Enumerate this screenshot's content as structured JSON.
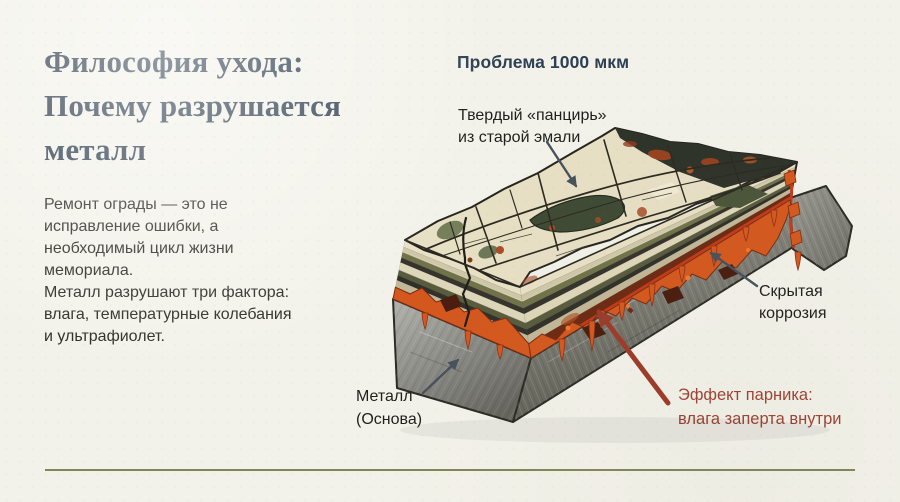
{
  "theme": {
    "background": "#f3f2ea",
    "title_color": "#2e3e4f",
    "body_color": "#2c2b26",
    "label_color": "#1f1f1c",
    "heading_color": "#2e4053",
    "red_accent": "#9d4234",
    "divider_color": "#70713f",
    "arrow_slate": "#47525c"
  },
  "header": {
    "title": "Философия ухода:\nПочему разрушается\nметалл"
  },
  "intro": {
    "paragraph": "Ремонт ограды — это не\nисправление ошибки, а\nнеобходимый цикл жизни\nмемориала.\nМеталл разрушают три фактора:\nвлага, температурные колебания\nи ультрафиолет."
  },
  "diagram": {
    "heading": "Проблема 1000 мкм",
    "labels": {
      "shell": "Твердый «панцирь»\nиз старой эмали",
      "hidden_corrosion": "Скрытая\nкоррозия",
      "metal_base": "Металл\n(Основа)",
      "greenhouse": "Эффект парника:\nвлага заперта внутри"
    }
  }
}
